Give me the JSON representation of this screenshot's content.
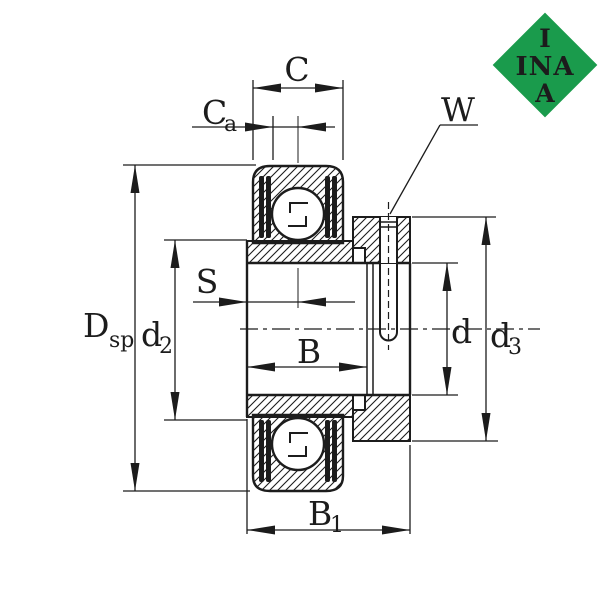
{
  "logo": {
    "shape": "diamond",
    "color": "#1a9b4c",
    "text_color": "#ffffff",
    "lines": [
      "I",
      "INA",
      "A"
    ]
  },
  "dimensions": {
    "C": {
      "label": "C"
    },
    "Ca": {
      "label": "C",
      "subscript": "a"
    },
    "W": {
      "label": "W"
    },
    "S": {
      "label": "S"
    },
    "B": {
      "label": "B"
    },
    "B1": {
      "label": "B",
      "subscript": "1"
    },
    "Dsp": {
      "label": "D",
      "subscript": "sp"
    },
    "d2": {
      "label": "d",
      "subscript": "2"
    },
    "d": {
      "label": "d"
    },
    "d3": {
      "label": "d",
      "subscript": "3"
    }
  },
  "colors": {
    "line": "#1c1c1c",
    "background": "#ffffff"
  }
}
